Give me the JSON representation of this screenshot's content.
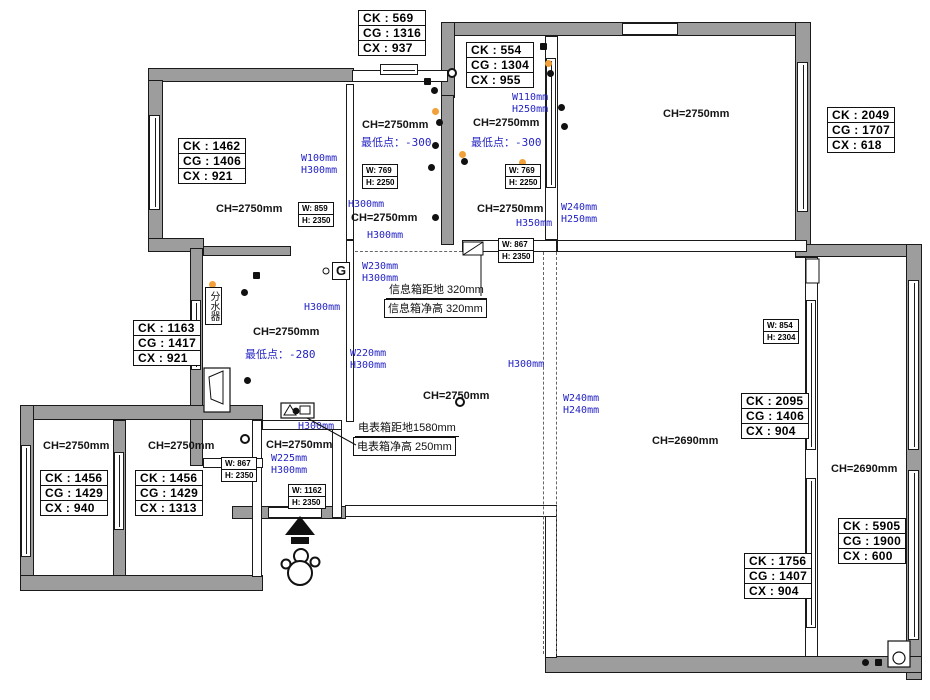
{
  "colors": {
    "wall_fill": "#9d9d9d",
    "line": "#1a1a1a",
    "dimension_blue": "#2424c4",
    "warm_light_orange": "#f2a13a"
  },
  "ch_labels": [
    "CH=2750mm",
    "CH=2750mm",
    "CH=2750mm",
    "CH=2750mm",
    "CH=2750mm",
    "CH=2750mm",
    "CH=2750mm",
    "CH=2750mm",
    "CH=2750mm",
    "CH=2750mm",
    "CH=2750mm",
    "CH=2690mm",
    "CH=2690mm"
  ],
  "measure_boxes": [
    {
      "lines": [
        "CK : 569",
        "CG : 1316",
        "CX : 937"
      ]
    },
    {
      "lines": [
        "CK : 554",
        "CG : 1304",
        "CX : 955"
      ]
    },
    {
      "lines": [
        "CK : 2049",
        "CG : 1707",
        "CX : 618"
      ]
    },
    {
      "lines": [
        "CK : 1462",
        "CG : 1406",
        "CX : 921"
      ]
    },
    {
      "lines": [
        "CK : 1163",
        "CG : 1417",
        "CX : 921"
      ]
    },
    {
      "lines": [
        "CK : 1456",
        "CG : 1429",
        "CX : 940"
      ]
    },
    {
      "lines": [
        "CK : 1456",
        "CG : 1429",
        "CX : 1313"
      ]
    },
    {
      "lines": [
        "CK : 2095",
        "CG : 1406",
        "CX : 904"
      ]
    },
    {
      "lines": [
        "CK : 1756",
        "CG : 1407",
        "CX : 904"
      ]
    },
    {
      "lines": [
        "CK : 5905",
        "CG : 1900",
        "CX : 600"
      ]
    }
  ],
  "window_boxes": [
    {
      "w": "W: 769",
      "h": "H: 2250"
    },
    {
      "w": "W: 769",
      "h": "H: 2250"
    },
    {
      "w": "W: 859",
      "h": "H: 2350"
    },
    {
      "w": "W: 867",
      "h": "H: 2350"
    },
    {
      "w": "W: 867",
      "h": "H: 2350"
    },
    {
      "w": "W: 854",
      "h": "H: 2304"
    },
    {
      "w": "W: 1162",
      "h": "H: 2350"
    }
  ],
  "dim_labels": [
    "W100mm\nH300mm",
    "W110mm\nH250mm",
    "H300mm",
    "H300mm",
    "W230mm\nH300mm",
    "H300mm",
    "W220mm\nH300mm",
    "H300mm",
    "W240mm\nH250mm",
    "H350mm",
    "W240mm\nH240mm",
    "H300mm",
    "W225mm\nH300mm",
    "最低点：-300",
    "最低点：-300",
    "最低点：-280"
  ],
  "notes": {
    "info_box_height": "信息箱距地 320mm",
    "info_box_clear": "信息箱净高 320mm",
    "meter_box_height": "电表箱距地1580mm",
    "meter_box_clear": "电表箱净高 250mm",
    "water_manifold": "分水器",
    "gas_meter": "G"
  },
  "fixtures": [
    {
      "type": "downlight",
      "x": 431,
      "y": 87
    },
    {
      "type": "downlight",
      "x": 436,
      "y": 119
    },
    {
      "type": "downlight",
      "x": 432,
      "y": 142
    },
    {
      "type": "downlight",
      "x": 428,
      "y": 164
    },
    {
      "type": "downlight",
      "x": 432,
      "y": 214
    },
    {
      "type": "downlight",
      "x": 461,
      "y": 158
    },
    {
      "type": "downlight",
      "x": 520,
      "y": 167
    },
    {
      "type": "downlight",
      "x": 547,
      "y": 70
    },
    {
      "type": "downlight",
      "x": 558,
      "y": 104
    },
    {
      "type": "downlight",
      "x": 561,
      "y": 123
    },
    {
      "type": "downlight",
      "x": 241,
      "y": 289
    },
    {
      "type": "downlight",
      "x": 244,
      "y": 377
    },
    {
      "type": "downlight",
      "x": 862,
      "y": 659
    },
    {
      "type": "spotlight",
      "x": 432,
      "y": 108
    },
    {
      "type": "spotlight",
      "x": 459,
      "y": 151
    },
    {
      "type": "spotlight",
      "x": 545,
      "y": 60
    },
    {
      "type": "spotlight",
      "x": 209,
      "y": 281
    },
    {
      "type": "spotlight",
      "x": 209,
      "y": 369
    },
    {
      "type": "spotlight",
      "x": 519,
      "y": 159
    },
    {
      "type": "socket",
      "x": 424,
      "y": 78
    },
    {
      "type": "socket",
      "x": 540,
      "y": 43
    },
    {
      "type": "socket",
      "x": 253,
      "y": 272
    },
    {
      "type": "socket",
      "x": 875,
      "y": 659
    },
    {
      "type": "drain",
      "x": 447,
      "y": 68
    },
    {
      "type": "drain",
      "x": 240,
      "y": 434
    },
    {
      "type": "drain",
      "x": 455,
      "y": 397
    }
  ]
}
